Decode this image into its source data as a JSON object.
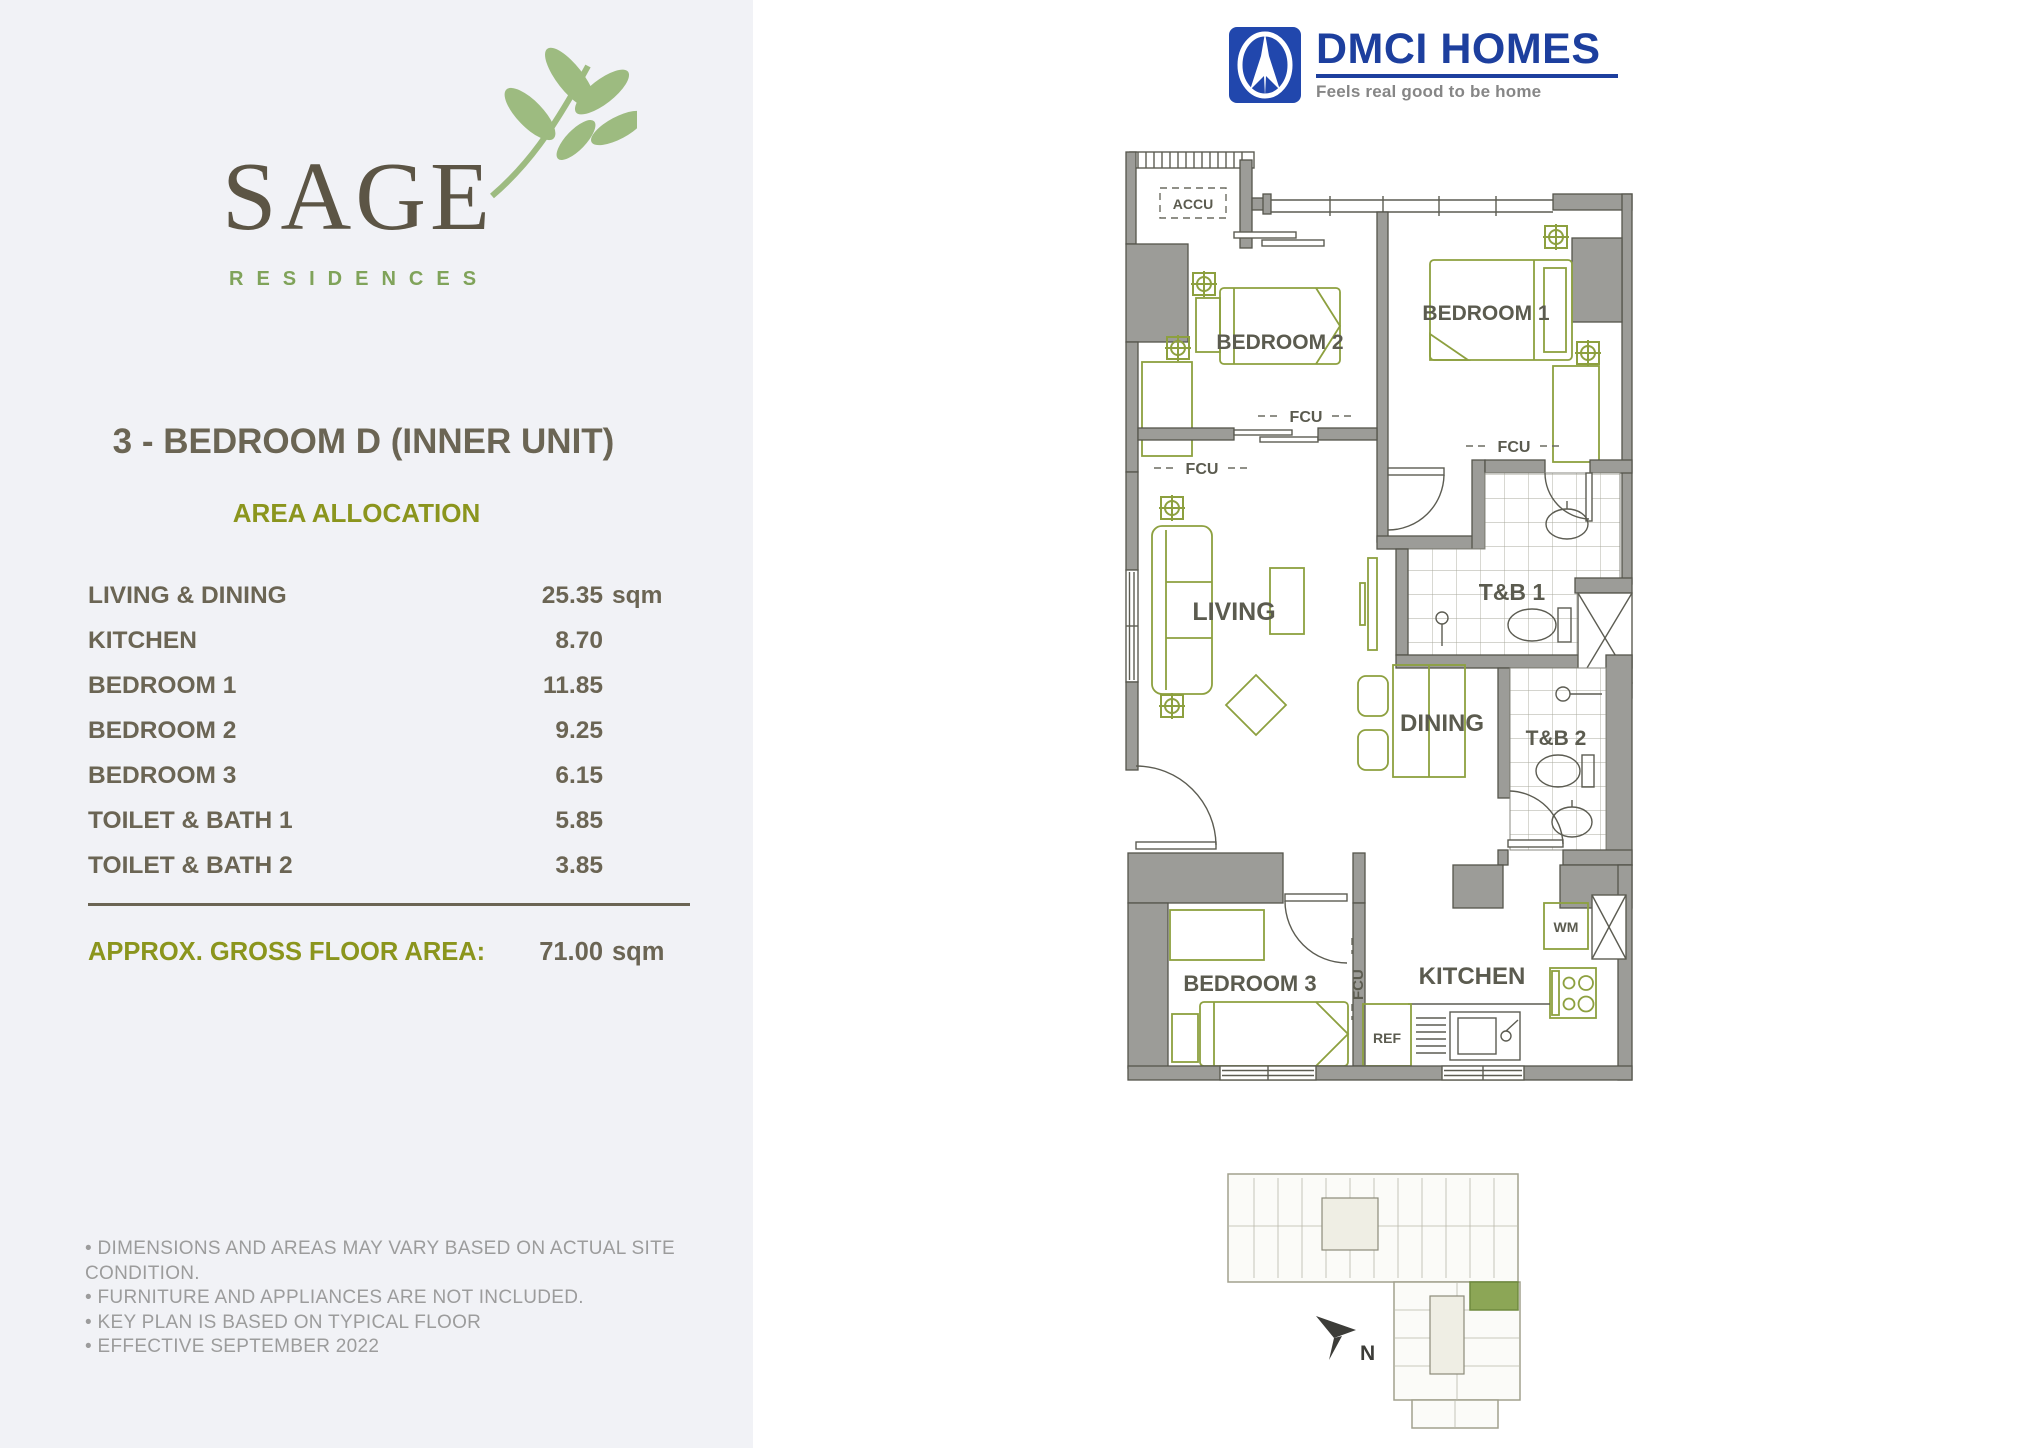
{
  "brand": {
    "name": "SAGE",
    "subtitle": "RESIDENCES"
  },
  "developer": {
    "name": "DMCI HOMES",
    "tagline": "Feels real good to be home"
  },
  "unit": {
    "title": "3 - BEDROOM D (INNER UNIT)",
    "section_title": "AREA ALLOCATION",
    "rows": [
      {
        "label": "LIVING & DINING",
        "value": "25.35",
        "unit": "sqm"
      },
      {
        "label": "KITCHEN",
        "value": "8.70",
        "unit": ""
      },
      {
        "label": "BEDROOM 1",
        "value": "11.85",
        "unit": ""
      },
      {
        "label": "BEDROOM 2",
        "value": "9.25",
        "unit": ""
      },
      {
        "label": "BEDROOM 3",
        "value": "6.15",
        "unit": ""
      },
      {
        "label": "TOILET & BATH 1",
        "value": "5.85",
        "unit": ""
      },
      {
        "label": "TOILET & BATH 2",
        "value": "3.85",
        "unit": ""
      }
    ],
    "gross": {
      "label": "APPROX. GROSS FLOOR AREA:",
      "value": "71.00",
      "unit": "sqm"
    }
  },
  "notes": [
    "• DIMENSIONS AND AREAS MAY VARY BASED ON ACTUAL SITE CONDITION.",
    "• FURNITURE AND APPLIANCES ARE NOT INCLUDED.",
    "• KEY PLAN IS BASED ON TYPICAL FLOOR",
    "• EFFECTIVE SEPTEMBER 2022"
  ],
  "floorplan": {
    "labels": {
      "accu": "ACCU",
      "bedroom1": "BEDROOM 1",
      "bedroom2": "BEDROOM 2",
      "bedroom3": "BEDROOM 3",
      "living": "LIVING",
      "dining": "DINING",
      "kitchen": "KITCHEN",
      "tb1": "T&B 1",
      "tb2": "T&B 2",
      "fcu": "FCU",
      "wm": "WM",
      "ref": "REF",
      "north": "N"
    }
  },
  "colors": {
    "panel_bg": "#f1f2f6",
    "accent_olive": "#8b951d",
    "text_dark": "#6b6554",
    "logo_green": "#80a35a",
    "leaf_green": "#9dbb80",
    "dmci_blue": "#1d3f9e",
    "wall_gray": "#9c9c98",
    "furniture_olive": "#8da03f",
    "keyplan_unit_green": "#8ca656",
    "note_gray": "#9c9c9c"
  }
}
